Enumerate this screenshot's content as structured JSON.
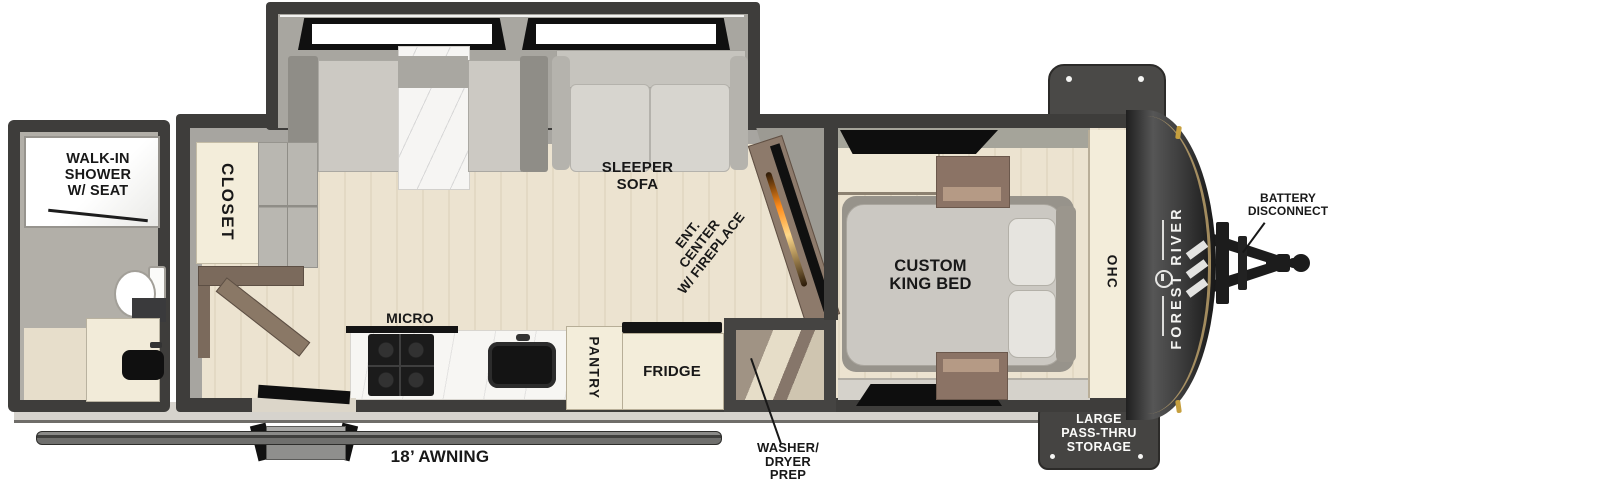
{
  "brand": {
    "name": "FOREST RIVER"
  },
  "rooms": {
    "bathroom": {
      "shower_label": "WALK-IN\nSHOWER\nW/ SEAT"
    },
    "living": {
      "closet_label": "CLOSET",
      "sofa_label": "SLEEPER\nSOFA",
      "ent_center_label": "ENT.\nCENTER\nW/ FIREPLACE"
    },
    "kitchen": {
      "micro_label": "MICRO",
      "pantry_label": "PANTRY",
      "fridge_label": "FRIDGE"
    },
    "utility": {
      "washer_dryer_label": "WASHER/\nDRYER\nPREP"
    },
    "bedroom": {
      "bed_label": "CUSTOM\nKING BED",
      "ohc_label": "OHC"
    }
  },
  "exterior": {
    "awning_label": "18’ AWNING",
    "battery_label": "BATTERY\nDISCONNECT",
    "storage_label": "LARGE\nPASS-THRU\nSTORAGE"
  },
  "palette": {
    "wall_dark": "#3e3d3b",
    "interior_wall_gray": "#a7a5a0",
    "floor_beige": "#ece3d0",
    "cabinet_cream": "#f3edda",
    "wood_brown": "#8a7866",
    "cushion_gray": "#d2d0ca",
    "front_cap_dark": "#262626",
    "fireplace_glow": "#ff8c1a",
    "clearance_light_amber": "#c69f3e",
    "label_black": "#181818"
  }
}
